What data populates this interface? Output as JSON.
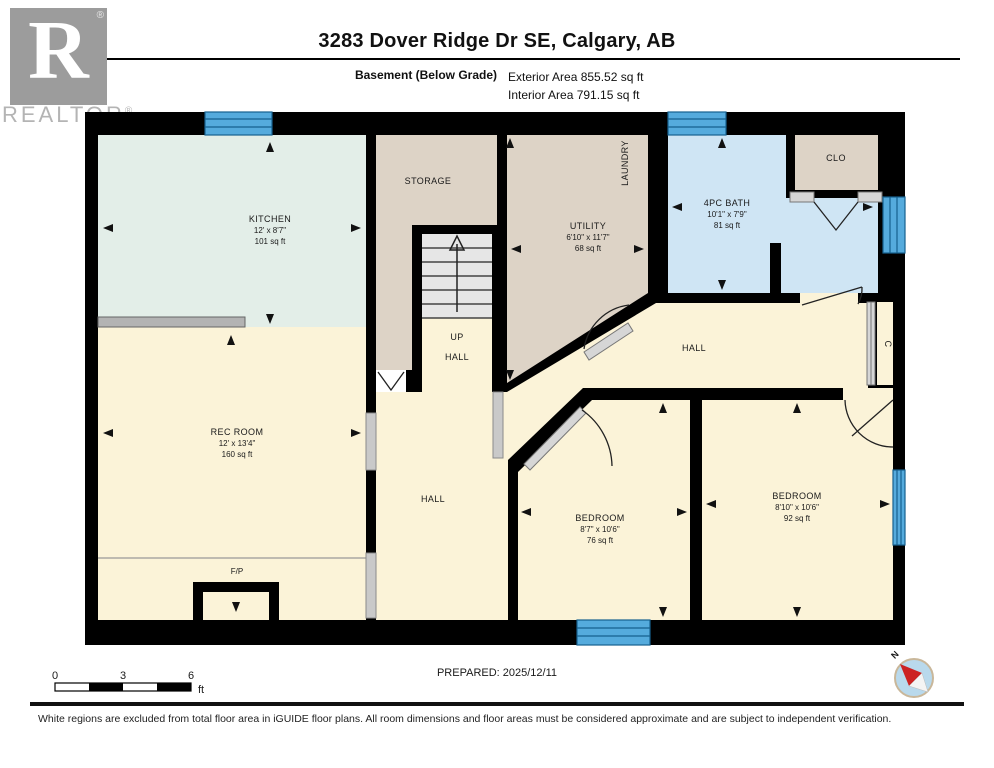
{
  "header": {
    "title": "3283 Dover Ridge Dr SE, Calgary, AB",
    "floor_label": "Basement (Below Grade)",
    "exterior_area": "Exterior Area 855.52 sq ft",
    "interior_area": "Interior Area 791.15 sq ft"
  },
  "branding": {
    "logo_letter": "R",
    "logo_text": "REALTOR",
    "reg_mark": "®"
  },
  "rooms": {
    "kitchen": {
      "name": "KITCHEN",
      "dims": "12' x 8'7\"",
      "area": "101 sq ft"
    },
    "storage": {
      "name": "STORAGE"
    },
    "utility": {
      "name": "UTILITY",
      "dims": "6'10\" x 11'7\"",
      "area": "68 sq ft"
    },
    "laundry": {
      "name": "LAUNDRY"
    },
    "bath": {
      "name": "4PC BATH",
      "dims": "10'1\" x 7'9\"",
      "area": "81 sq ft"
    },
    "clo": {
      "name": "CLO"
    },
    "closet_c": {
      "name": "C"
    },
    "hall_right": {
      "name": "HALL"
    },
    "hall_center": {
      "name": "HALL"
    },
    "stair_up": {
      "name": "UP"
    },
    "stair_hall": {
      "name": "HALL"
    },
    "rec_room": {
      "name": "REC ROOM",
      "dims": "12' x 13'4\"",
      "area": "160 sq ft"
    },
    "fireplace": {
      "name": "F/P"
    },
    "bedroom1": {
      "name": "BEDROOM",
      "dims": "8'7\" x 10'6\"",
      "area": "76 sq ft"
    },
    "bedroom2": {
      "name": "BEDROOM",
      "dims": "8'10\" x 10'6\"",
      "area": "92 sq ft"
    }
  },
  "scale_bar": {
    "tick_0": "0",
    "tick_3": "3",
    "tick_6": "6",
    "unit": "ft"
  },
  "compass": {
    "north_label": "N"
  },
  "footer": {
    "prepared": "PREPARED: 2025/12/11",
    "disclaimer": "White regions are excluded from total floor area in iGUIDE floor plans. All room dimensions and floor areas must be considered approximate and are subject to independent verification."
  },
  "colors": {
    "wall": "#000000",
    "cream": "#fbf3d8",
    "tan": "#ddd3c6",
    "mint": "#e3eee8",
    "bath_blue": "#cfe5f4",
    "window_blue": "#55abdd",
    "stair_gray": "#e6e6e6",
    "logo_gray": "#9c9c9c",
    "compass_red": "#cc2222"
  }
}
